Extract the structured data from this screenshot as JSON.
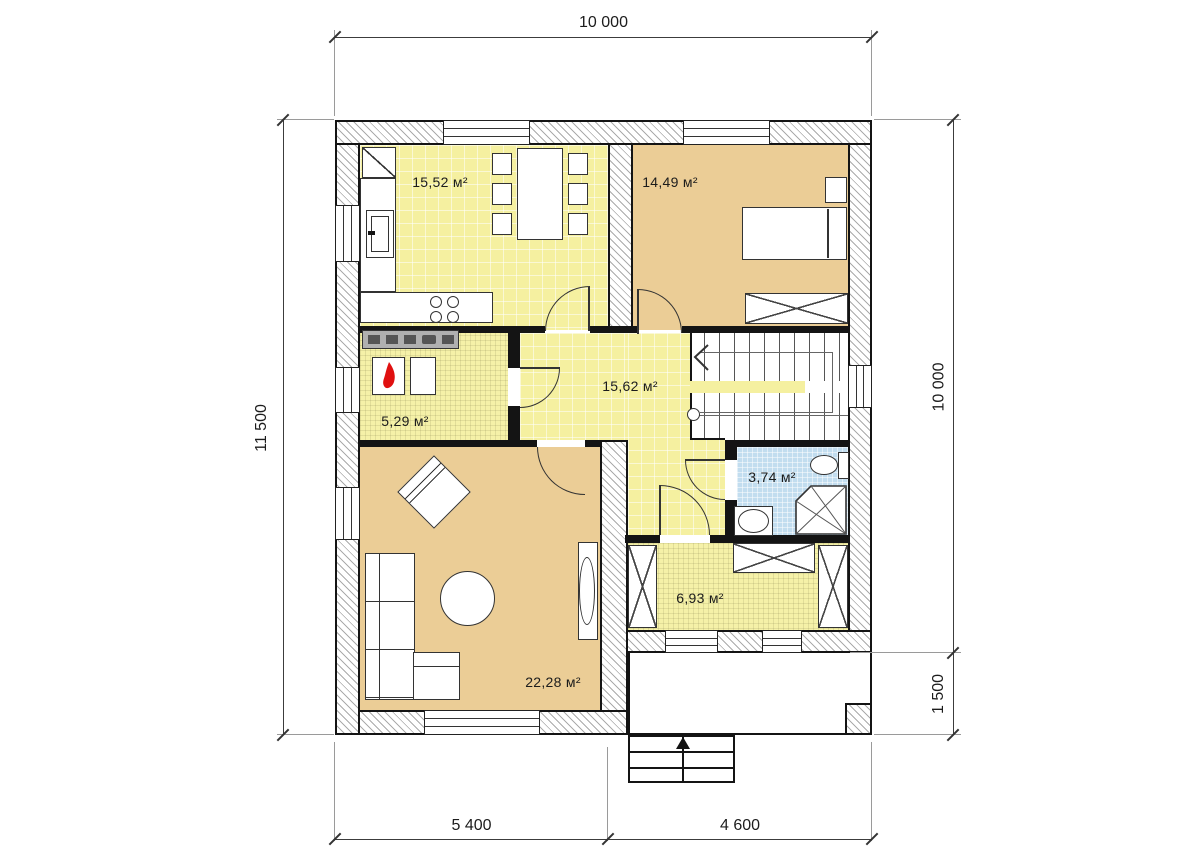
{
  "drawing": {
    "type": "floor-plan",
    "units": "mm"
  },
  "dimensions": {
    "top_width": "10 000",
    "left_height": "11 500",
    "right_height": "10 000",
    "right_porch_depth": "1 500",
    "bottom_left_width": "5 400",
    "bottom_right_width": "4 600"
  },
  "rooms": {
    "kitchen_dining": {
      "area": "15,52 м²"
    },
    "bedroom": {
      "area": "14,49 м²"
    },
    "boiler_room": {
      "area": "5,29 м²"
    },
    "hall": {
      "area": "15,62 м²"
    },
    "bathroom": {
      "area": "3,74 м²"
    },
    "vestibule": {
      "area": "6,93 м²"
    },
    "living_room": {
      "area": "22,28 м²"
    }
  },
  "colors": {
    "room_yellow": "#f5f0a0",
    "room_fine_yellow": "#f5f1a8",
    "room_tan": "#ebcd96",
    "room_blue": "#c2ddef",
    "flame_red": "#e01010",
    "hatch_gray": "#ababab"
  },
  "icons": {
    "stair_direction": "chevron-left",
    "entry_direction": "arrow-up",
    "boiler": "flame"
  }
}
